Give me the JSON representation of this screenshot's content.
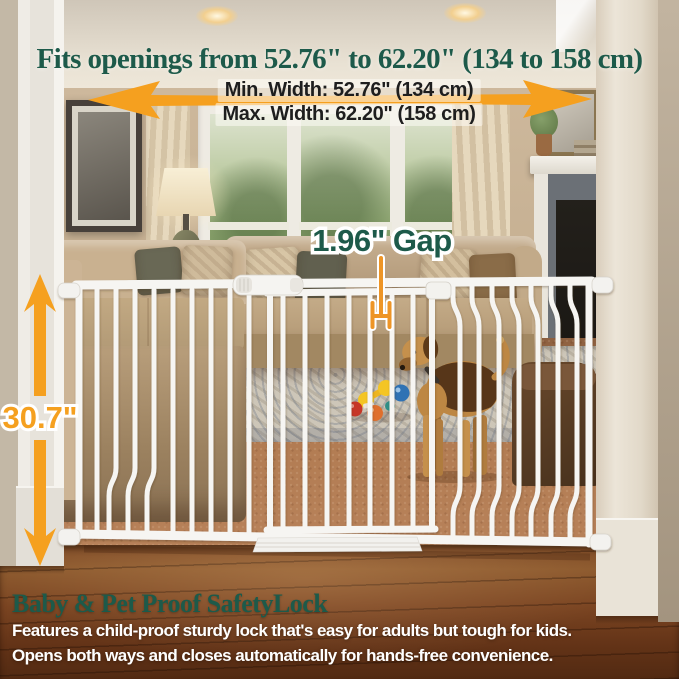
{
  "annotations": {
    "headline": "Fits openings from 52.76\" to 62.20\" (134 to 158 cm)",
    "min_width_label": "Min. Width: 52.76\" (134 cm)",
    "max_width_label": "Max. Width: 62.20\" (158 cm)",
    "gap_label": "1.96\" Gap",
    "height_label": "30.7\""
  },
  "footer": {
    "title": "Baby & Pet Proof SafetyLock",
    "line1": "Features a child-proof sturdy lock that's easy for adults but tough for kids.",
    "line2": "Opens both ways and closes automatically for hands-free convenience."
  },
  "icons": {
    "width_arrow": "horizontal-double-arrow",
    "height_arrow": "vertical-double-arrow",
    "gap_marker": "gap-measure-bracket"
  },
  "colors": {
    "accent_green": "#1d5a4a",
    "accent_orange": "#F5A01F",
    "label_text": "#1e1e1e",
    "footer_text": "#ffffff"
  }
}
